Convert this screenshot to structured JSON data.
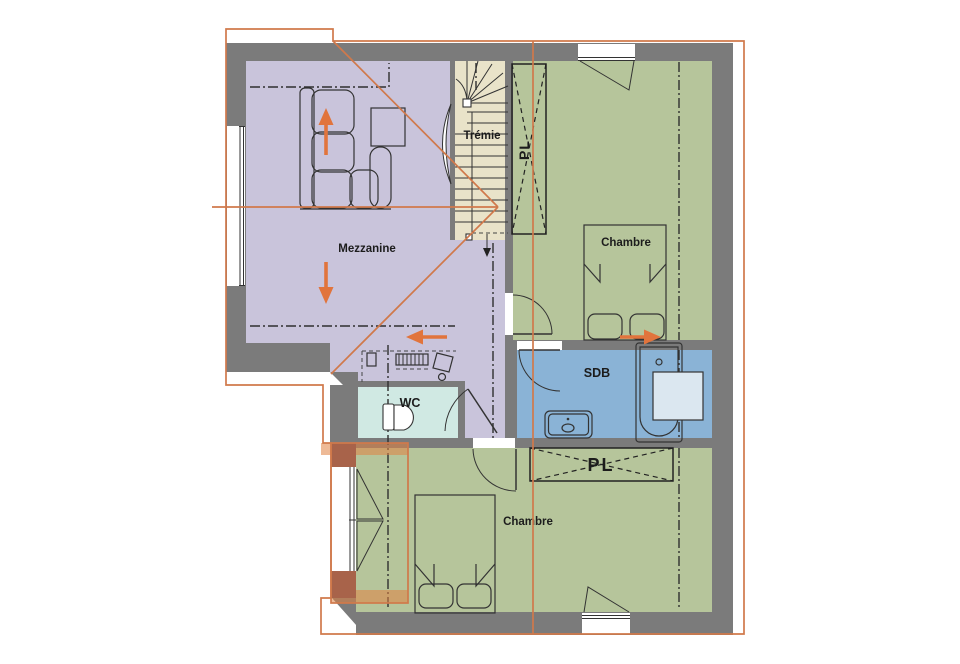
{
  "plan": {
    "rooms": {
      "mezzanine": {
        "label": "Mezzanine",
        "color": "#c9c4db"
      },
      "stairwell": {
        "label": "Trémie",
        "color": "#e9e3c9"
      },
      "chambre_top": {
        "label": "Chambre",
        "color": "#b6c59b"
      },
      "chambre_bottom": {
        "label": "Chambre",
        "color": "#b6c59b"
      },
      "sdb": {
        "label": "SDB",
        "color": "#8ab3d6"
      },
      "wc": {
        "label": "WC",
        "color": "#d0e9e3"
      },
      "closet_top": {
        "label": "PL"
      },
      "closet_bottom": {
        "label": "PL"
      }
    },
    "colors": {
      "wall": "#7b7b7b",
      "roof_line": "#d0794b",
      "arrow": "#e1743c",
      "dormer_wall": "#a8634a",
      "dormer_fill": "#e08242",
      "shower_tray": "#dbe7f0"
    }
  }
}
